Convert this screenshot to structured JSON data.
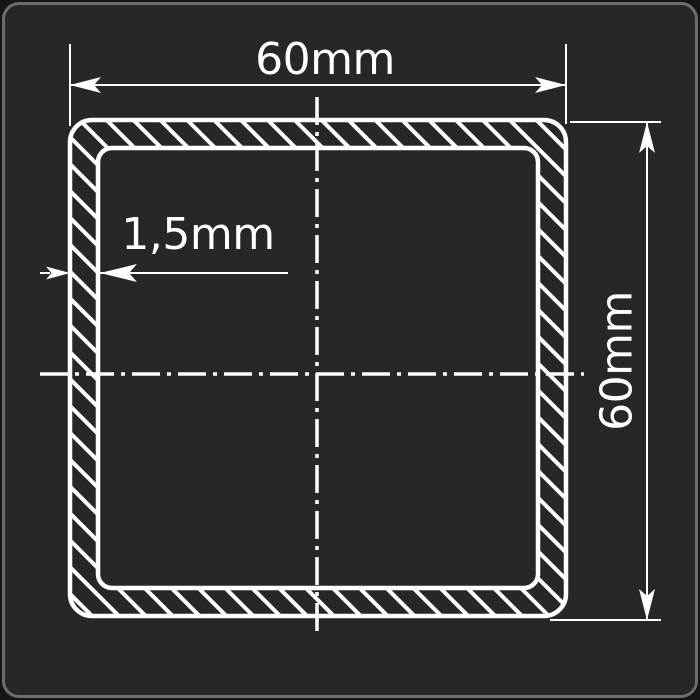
{
  "frame": {
    "background": "#272727",
    "border_color": "#6d6d6d",
    "outside_color": "#151515"
  },
  "drawing": {
    "line_color": "#ffffff",
    "labels": {
      "width": "60mm",
      "height": "60mm",
      "wall_thickness": "1,5mm"
    }
  }
}
